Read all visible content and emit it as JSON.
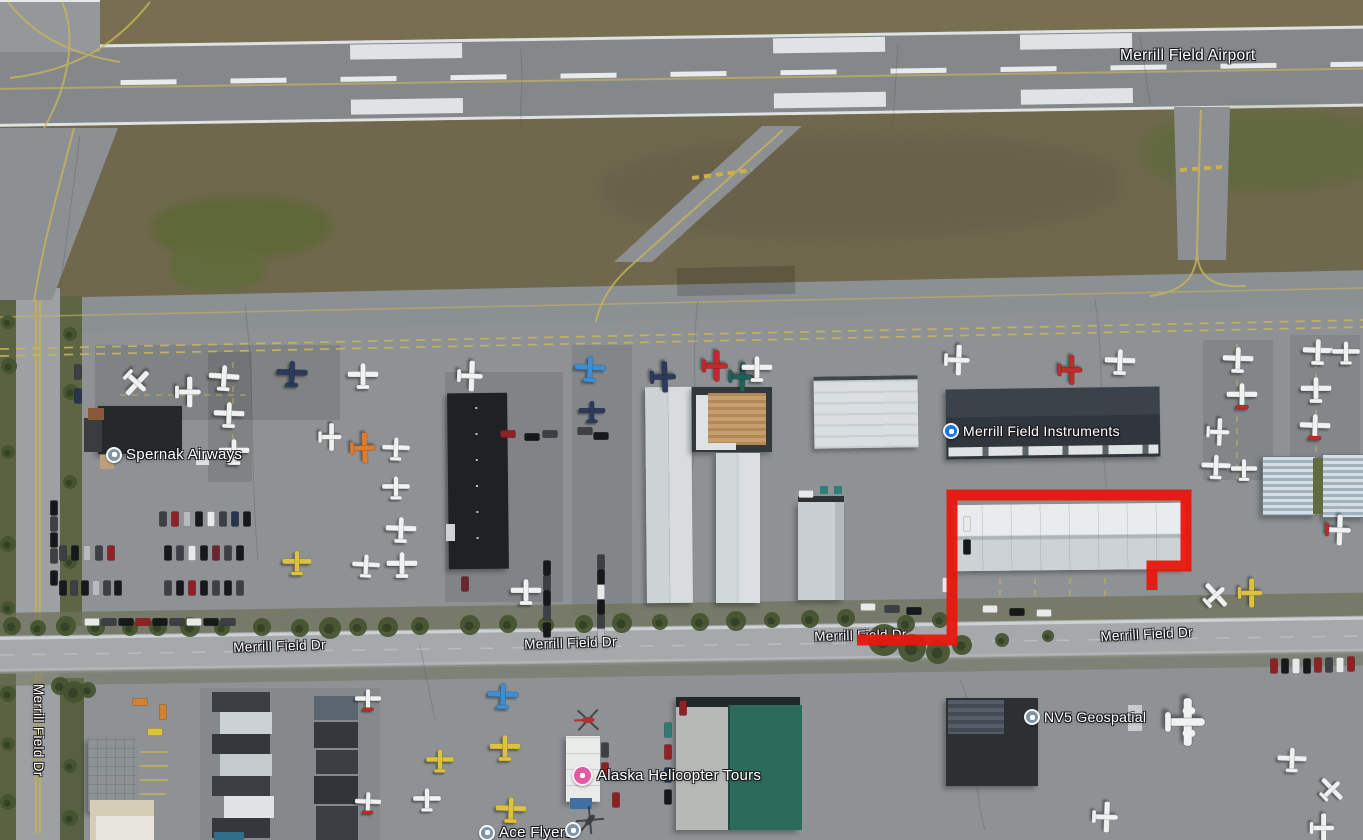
{
  "map": {
    "place_labels": [
      {
        "id": "merrill-field-airport",
        "text": "Merrill Field Airport",
        "x": 1120,
        "y": 47,
        "size": 15.5,
        "rot": 0,
        "icon": null
      },
      {
        "id": "spernak-airways",
        "text": "Spernak Airways",
        "x": 106,
        "y": 446,
        "size": 15,
        "rot": 0,
        "icon": "gray",
        "icon_d": 16
      },
      {
        "id": "merrill-field-instruments",
        "text": "Merrill Field Instruments",
        "x": 943,
        "y": 423,
        "size": 14,
        "rot": 0,
        "icon": "blue",
        "icon_d": 16
      },
      {
        "id": "nv5-geospatial",
        "text": "NV5 Geospatial",
        "x": 1024,
        "y": 709,
        "size": 14,
        "rot": 0,
        "icon": "gray",
        "icon_d": 16
      },
      {
        "id": "alaska-helicopter-tours",
        "text": "Alaska Helicopter Tours",
        "x": 572,
        "y": 765,
        "size": 15,
        "rot": 0,
        "icon": "pink",
        "icon_d": 21
      },
      {
        "id": "ace-flyers",
        "text": "Ace Flyers",
        "x": 479,
        "y": 824,
        "size": 15,
        "rot": 0,
        "icon": "gray",
        "icon_d": 16
      }
    ],
    "extra_icons": [
      {
        "id": "ace-flyers-2",
        "type": "gray",
        "x": 565,
        "y": 822,
        "d": 16
      }
    ],
    "road_labels": [
      {
        "text": "Merrill Field Dr",
        "x": 233,
        "y": 640,
        "rot": -1.8
      },
      {
        "text": "Merrill Field Dr",
        "x": 524,
        "y": 637,
        "rot": -1.8
      },
      {
        "text": "Merrill Field Dr",
        "x": 814,
        "y": 629,
        "rot": -1.5
      },
      {
        "text": "Merrill Field Dr",
        "x": 1100,
        "y": 629,
        "rot": -2.8
      },
      {
        "text": "Merrill Field Dr",
        "x": 46,
        "y": 684,
        "rot": 90
      }
    ],
    "icon_colors": {
      "gray": "#7f95a6",
      "blue": "#1a73e8",
      "pink": "#e25aa2"
    },
    "annotation": {
      "color": "#e8170c",
      "width": 11,
      "points": [
        [
          857,
          640
        ],
        [
          952,
          640
        ],
        [
          952,
          495
        ],
        [
          1186,
          495
        ],
        [
          1186,
          566
        ],
        [
          1152,
          566
        ],
        [
          1152,
          590
        ]
      ]
    },
    "plane_colors": {
      "w": "#f0f2f2",
      "nv": "#2c3b5c",
      "bl": "#3f8ed4",
      "rd": "#bf2a2a",
      "tl": "#20605a",
      "or": "#dd7c2e",
      "yl": "#ddc23d",
      "wr": "#f0f2f2"
    },
    "planes": [
      [
        136,
        382,
        133,
        "w",
        1
      ],
      [
        188,
        392,
        90,
        "w",
        1
      ],
      [
        224,
        378,
        4,
        "w",
        1
      ],
      [
        229,
        415,
        2,
        "w",
        1
      ],
      [
        234,
        452,
        0,
        "w",
        1
      ],
      [
        292,
        374,
        2,
        "nv",
        1
      ],
      [
        363,
        376,
        0,
        "w",
        1
      ],
      [
        330,
        437,
        90,
        "w",
        0.9
      ],
      [
        363,
        448,
        88,
        "or",
        1
      ],
      [
        396,
        449,
        2,
        "w",
        0.9
      ],
      [
        396,
        488,
        0,
        "w",
        0.9
      ],
      [
        401,
        530,
        2,
        "w",
        1
      ],
      [
        402,
        565,
        0,
        "w",
        1
      ],
      [
        366,
        566,
        3,
        "w",
        0.9
      ],
      [
        297,
        563,
        0,
        "yl",
        0.95
      ],
      [
        470,
        376,
        92,
        "w",
        1
      ],
      [
        590,
        369,
        3,
        "bl",
        1
      ],
      [
        592,
        412,
        0,
        "nv",
        0.85
      ],
      [
        663,
        377,
        88,
        "nv",
        1
      ],
      [
        715,
        366,
        90,
        "rd",
        1
      ],
      [
        741,
        377,
        92,
        "tl",
        0.95
      ],
      [
        757,
        369,
        0,
        "w",
        1
      ],
      [
        526,
        592,
        0,
        "w",
        1
      ],
      [
        957,
        360,
        92,
        "w",
        1
      ],
      [
        1070,
        370,
        90,
        "rd",
        0.95
      ],
      [
        1120,
        362,
        2,
        "w",
        1
      ],
      [
        1238,
        360,
        2,
        "w",
        1
      ],
      [
        1242,
        396,
        0,
        "wr",
        1
      ],
      [
        1218,
        432,
        92,
        "w",
        0.9
      ],
      [
        1216,
        467,
        2,
        "w",
        0.95
      ],
      [
        1244,
        470,
        0,
        "w",
        0.85
      ],
      [
        1318,
        352,
        2,
        "w",
        1
      ],
      [
        1346,
        353,
        0,
        "w",
        0.9
      ],
      [
        1316,
        390,
        0,
        "w",
        1
      ],
      [
        1315,
        427,
        2,
        "wr",
        1
      ],
      [
        1338,
        530,
        92,
        "wr",
        1
      ],
      [
        1250,
        593,
        90,
        "yl",
        0.95
      ],
      [
        1215,
        596,
        48,
        "w",
        0.95
      ],
      [
        503,
        696,
        2,
        "bl",
        1
      ],
      [
        505,
        748,
        0,
        "yl",
        1
      ],
      [
        511,
        810,
        2,
        "yl",
        1
      ],
      [
        440,
        761,
        0,
        "yl",
        0.9
      ],
      [
        427,
        800,
        0,
        "w",
        0.9
      ],
      [
        368,
        700,
        0,
        "wr",
        0.85
      ],
      [
        368,
        803,
        2,
        "wr",
        0.85
      ],
      [
        1185,
        722,
        90,
        "w",
        1.55
      ],
      [
        1105,
        817,
        92,
        "w",
        1
      ],
      [
        1292,
        760,
        2,
        "w",
        0.95
      ],
      [
        1331,
        790,
        46,
        "w",
        0.9
      ],
      [
        1322,
        828,
        90,
        "w",
        0.95
      ]
    ],
    "helicopters": [
      [
        588,
        720,
        88,
        "#b43131"
      ],
      [
        590,
        820,
        40,
        "#3c4043"
      ]
    ],
    "vehicle_colors": {
      "bk": "#16181a",
      "dk": "#3c4045",
      "wt": "#e8eae9",
      "sv": "#b7bbbd",
      "rd": "#8f2125",
      "mr": "#6e2430",
      "nv": "#263450",
      "tl": "#2f7a72",
      "or": "#d08433",
      "yl": "#d9c33e"
    },
    "vehicles": [
      [
        163,
        519,
        0,
        "dk"
      ],
      [
        175,
        519,
        0,
        "rd"
      ],
      [
        187,
        519,
        0,
        "sv"
      ],
      [
        199,
        519,
        0,
        "bk"
      ],
      [
        211,
        519,
        0,
        "wt"
      ],
      [
        223,
        519,
        0,
        "dk"
      ],
      [
        235,
        519,
        0,
        "nv"
      ],
      [
        247,
        519,
        0,
        "bk"
      ],
      [
        63,
        553,
        0,
        "dk"
      ],
      [
        75,
        553,
        0,
        "bk"
      ],
      [
        87,
        553,
        0,
        "sv"
      ],
      [
        99,
        553,
        0,
        "dk"
      ],
      [
        111,
        553,
        0,
        "rd"
      ],
      [
        168,
        553,
        0,
        "bk"
      ],
      [
        180,
        553,
        0,
        "dk"
      ],
      [
        192,
        553,
        0,
        "wt"
      ],
      [
        204,
        553,
        0,
        "bk"
      ],
      [
        216,
        553,
        0,
        "mr"
      ],
      [
        228,
        553,
        0,
        "dk"
      ],
      [
        240,
        553,
        0,
        "bk"
      ],
      [
        63,
        588,
        0,
        "bk"
      ],
      [
        74,
        588,
        0,
        "dk"
      ],
      [
        85,
        588,
        0,
        "bk"
      ],
      [
        96,
        588,
        0,
        "sv"
      ],
      [
        107,
        588,
        0,
        "dk"
      ],
      [
        118,
        588,
        0,
        "bk"
      ],
      [
        168,
        588,
        0,
        "dk"
      ],
      [
        180,
        588,
        0,
        "bk"
      ],
      [
        192,
        588,
        0,
        "rd"
      ],
      [
        204,
        588,
        0,
        "bk"
      ],
      [
        216,
        588,
        0,
        "dk"
      ],
      [
        228,
        588,
        0,
        "bk"
      ],
      [
        240,
        588,
        0,
        "dk"
      ],
      [
        92,
        622,
        90,
        "wt"
      ],
      [
        109,
        622,
        90,
        "dk"
      ],
      [
        126,
        622,
        90,
        "bk"
      ],
      [
        143,
        622,
        90,
        "rd"
      ],
      [
        160,
        622,
        90,
        "bk"
      ],
      [
        177,
        622,
        90,
        "dk"
      ],
      [
        194,
        622,
        90,
        "wt"
      ],
      [
        211,
        622,
        90,
        "bk"
      ],
      [
        228,
        622,
        90,
        "dk"
      ],
      [
        54,
        508,
        0,
        "bk"
      ],
      [
        54,
        524,
        0,
        "dk"
      ],
      [
        54,
        540,
        0,
        "bk"
      ],
      [
        54,
        556,
        0,
        "dk"
      ],
      [
        54,
        578,
        0,
        "bk"
      ],
      [
        78,
        372,
        0,
        "dk"
      ],
      [
        78,
        396,
        0,
        "nv"
      ],
      [
        508,
        434,
        90,
        "rd"
      ],
      [
        532,
        437,
        90,
        "bk"
      ],
      [
        550,
        434,
        90,
        "dk"
      ],
      [
        585,
        431,
        90,
        "dk"
      ],
      [
        601,
        436,
        90,
        "bk"
      ],
      [
        547,
        568,
        0,
        "bk"
      ],
      [
        547,
        583,
        0,
        "dk"
      ],
      [
        547,
        598,
        0,
        "bk"
      ],
      [
        547,
        613,
        0,
        "dk"
      ],
      [
        547,
        630,
        0,
        "bk"
      ],
      [
        601,
        562,
        0,
        "dk"
      ],
      [
        601,
        577,
        0,
        "bk"
      ],
      [
        601,
        592,
        0,
        "wt"
      ],
      [
        601,
        607,
        0,
        "bk"
      ],
      [
        601,
        622,
        0,
        "dk"
      ],
      [
        601,
        636,
        0,
        "sv"
      ],
      [
        868,
        607,
        90,
        "wt"
      ],
      [
        892,
        609,
        90,
        "dk"
      ],
      [
        914,
        611,
        90,
        "bk"
      ],
      [
        806,
        494,
        90,
        "wt"
      ],
      [
        967,
        524,
        0,
        "wt"
      ],
      [
        967,
        547,
        0,
        "bk"
      ],
      [
        946,
        585,
        0,
        "wt"
      ],
      [
        990,
        609,
        90,
        "wt"
      ],
      [
        1017,
        612,
        90,
        "bk"
      ],
      [
        1044,
        613,
        90,
        "wt"
      ],
      [
        465,
        584,
        0,
        "mr"
      ],
      [
        1274,
        666,
        0,
        "rd"
      ],
      [
        1285,
        666,
        0,
        "bk"
      ],
      [
        1296,
        666,
        0,
        "wt"
      ],
      [
        1307,
        666,
        0,
        "bk"
      ],
      [
        1318,
        665,
        0,
        "rd"
      ],
      [
        1329,
        665,
        0,
        "dk"
      ],
      [
        1340,
        665,
        0,
        "wt"
      ],
      [
        1351,
        664,
        0,
        "rd"
      ],
      [
        668,
        730,
        0,
        "tl"
      ],
      [
        668,
        752,
        0,
        "rd"
      ],
      [
        668,
        775,
        0,
        "nv"
      ],
      [
        668,
        797,
        0,
        "bk"
      ],
      [
        683,
        708,
        0,
        "rd"
      ],
      [
        605,
        750,
        0,
        "dk"
      ],
      [
        605,
        770,
        0,
        "rd"
      ],
      [
        616,
        800,
        0,
        "rd"
      ],
      [
        140,
        702,
        90,
        "or"
      ],
      [
        163,
        712,
        0,
        "or"
      ],
      [
        155,
        732,
        90,
        "yl"
      ]
    ],
    "trees": [
      [
        12,
        626,
        9
      ],
      [
        38,
        628,
        8
      ],
      [
        66,
        626,
        10
      ],
      [
        96,
        627,
        9
      ],
      [
        130,
        628,
        8
      ],
      [
        158,
        627,
        9
      ],
      [
        190,
        627,
        10
      ],
      [
        222,
        628,
        8
      ],
      [
        262,
        627,
        9
      ],
      [
        300,
        628,
        9
      ],
      [
        330,
        628,
        11
      ],
      [
        358,
        627,
        9
      ],
      [
        388,
        627,
        10
      ],
      [
        420,
        626,
        9
      ],
      [
        470,
        625,
        10
      ],
      [
        508,
        624,
        9
      ],
      [
        546,
        625,
        8
      ],
      [
        584,
        624,
        9
      ],
      [
        622,
        623,
        10
      ],
      [
        660,
        622,
        8
      ],
      [
        700,
        622,
        9
      ],
      [
        736,
        621,
        10
      ],
      [
        772,
        620,
        8
      ],
      [
        810,
        619,
        9
      ],
      [
        846,
        618,
        9
      ],
      [
        884,
        640,
        16
      ],
      [
        912,
        648,
        14
      ],
      [
        938,
        652,
        12
      ],
      [
        962,
        645,
        10
      ],
      [
        906,
        624,
        9
      ],
      [
        940,
        620,
        8
      ],
      [
        1002,
        640,
        7
      ],
      [
        1048,
        636,
        6
      ],
      [
        8,
        322,
        7
      ],
      [
        9,
        366,
        8
      ],
      [
        70,
        334,
        7
      ],
      [
        71,
        392,
        8
      ],
      [
        8,
        452,
        7
      ],
      [
        70,
        482,
        7
      ],
      [
        8,
        544,
        8
      ],
      [
        70,
        562,
        7
      ],
      [
        8,
        608,
        7
      ],
      [
        60,
        686,
        9
      ],
      [
        74,
        692,
        11
      ],
      [
        88,
        690,
        8
      ],
      [
        8,
        694,
        8
      ],
      [
        8,
        744,
        7
      ],
      [
        8,
        802,
        8
      ],
      [
        70,
        766,
        7
      ],
      [
        70,
        818,
        8
      ]
    ]
  }
}
